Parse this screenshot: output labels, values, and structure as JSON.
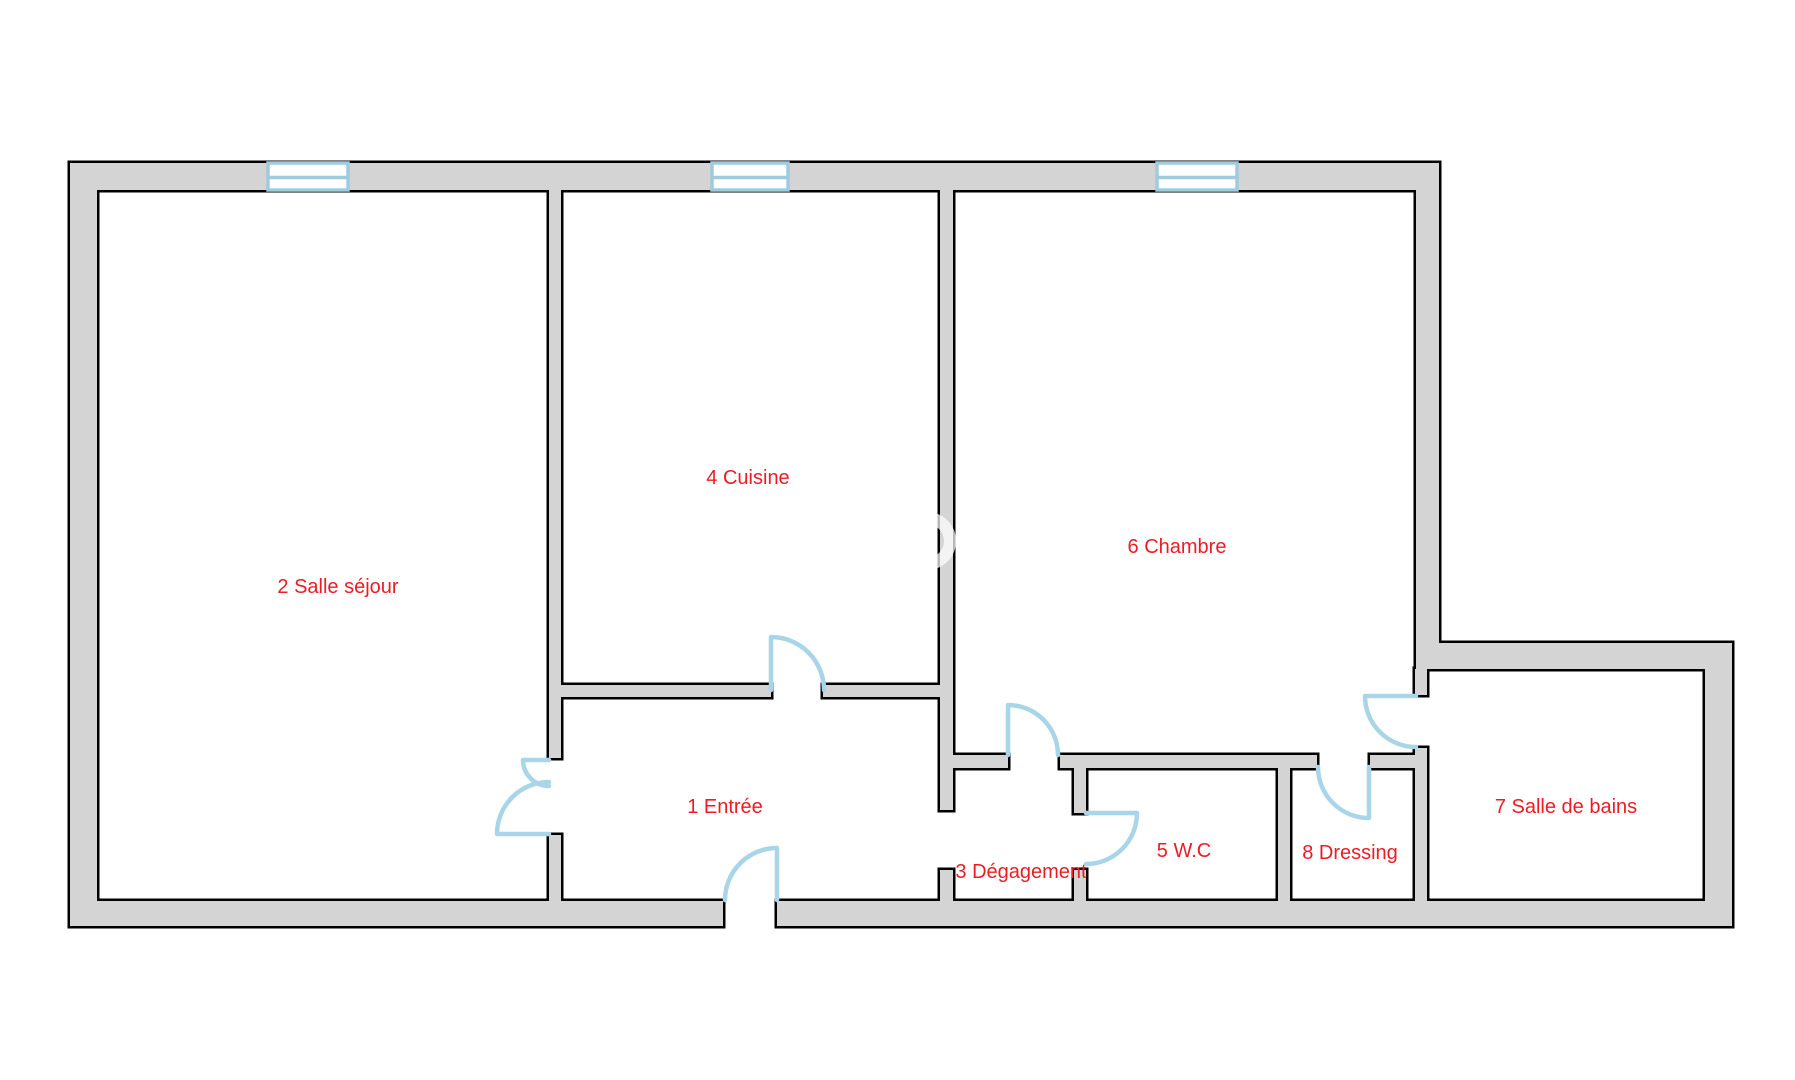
{
  "page": {
    "background": "#ffffff",
    "width": 1795,
    "height": 1080
  },
  "palette": {
    "wall_fill": "#d4d4d4",
    "wall_outline": "#000000",
    "window_color": "#9fcbdf",
    "door_color": "#a8d5e8",
    "label_color": "#ed1c24",
    "watermark_color": "rgba(255,255,255,0.72)"
  },
  "rooms": [
    {
      "number": "1",
      "name": "Entrée",
      "label": "1 Entrée",
      "cx": 725,
      "cy": 807
    },
    {
      "number": "2",
      "name": "Salle séjour",
      "label": "2 Salle séjour",
      "cx": 338,
      "cy": 587
    },
    {
      "number": "3",
      "name": "Dégagement",
      "label": "3 Dégagement",
      "cx": 1021,
      "cy": 872
    },
    {
      "number": "4",
      "name": "Cuisine",
      "label": "4 Cuisine",
      "cx": 748,
      "cy": 478
    },
    {
      "number": "5",
      "name": "W.C",
      "label": "5 W.C",
      "cx": 1184,
      "cy": 851
    },
    {
      "number": "6",
      "name": "Chambre",
      "label": "6 Chambre",
      "cx": 1177,
      "cy": 547
    },
    {
      "number": "7",
      "name": "Salle de bains",
      "label": "7 Salle de bains",
      "cx": 1566,
      "cy": 807
    },
    {
      "number": "8",
      "name": "Dressing",
      "label": "8 Dressing",
      "cx": 1350,
      "cy": 853
    }
  ],
  "floorplan": {
    "outline_pad": 2.5,
    "walls": [
      {
        "name": "exterior-top",
        "x": 70,
        "y": 163,
        "w": 1369,
        "h": 27
      },
      {
        "name": "exterior-left",
        "x": 70,
        "y": 163,
        "w": 27,
        "h": 763
      },
      {
        "name": "exterior-bottom-left",
        "x": 70,
        "y": 901,
        "w": 653,
        "h": 25
      },
      {
        "name": "exterior-bottom-right",
        "x": 777,
        "y": 901,
        "w": 953,
        "h": 25
      },
      {
        "name": "exterior-right-main",
        "x": 1416,
        "y": 163,
        "w": 23,
        "h": 506
      },
      {
        "name": "exterior-right-stub",
        "x": 1415,
        "y": 669,
        "w": 12,
        "h": 26
      },
      {
        "name": "extension-top",
        "x": 1416,
        "y": 643,
        "w": 314,
        "h": 26
      },
      {
        "name": "extension-right",
        "x": 1705,
        "y": 643,
        "w": 27,
        "h": 283
      },
      {
        "name": "sejour-cuisine-upper",
        "x": 549,
        "y": 190,
        "w": 12,
        "h": 568
      },
      {
        "name": "sejour-lower",
        "x": 549,
        "y": 835,
        "w": 12,
        "h": 66
      },
      {
        "name": "cuisine-bottom-left",
        "x": 549,
        "y": 685,
        "w": 222,
        "h": 12
      },
      {
        "name": "cuisine-bottom-right",
        "x": 823,
        "y": 685,
        "w": 129,
        "h": 12
      },
      {
        "name": "cuisine-chambre",
        "x": 940,
        "y": 190,
        "w": 13,
        "h": 620
      },
      {
        "name": "degagement-stub-horiz",
        "x": 952,
        "y": 755,
        "w": 56,
        "h": 13
      },
      {
        "name": "degagement-stub-lower",
        "x": 940,
        "y": 870,
        "w": 13,
        "h": 31
      },
      {
        "name": "chambre-bottom",
        "x": 1060,
        "y": 755,
        "w": 257,
        "h": 13
      },
      {
        "name": "dressing-top",
        "x": 1370,
        "y": 755,
        "w": 45,
        "h": 13
      },
      {
        "name": "wc-left-upper",
        "x": 1074,
        "y": 768,
        "w": 12,
        "h": 45
      },
      {
        "name": "wc-left-lower",
        "x": 1074,
        "y": 870,
        "w": 12,
        "h": 31
      },
      {
        "name": "wc-dressing-divider",
        "x": 1278,
        "y": 768,
        "w": 12,
        "h": 133
      },
      {
        "name": "bathroom-left",
        "x": 1415,
        "y": 748,
        "w": 12,
        "h": 153
      }
    ],
    "windows": [
      {
        "name": "window-sejour",
        "x": 268,
        "y": 163,
        "w": 80,
        "h": 27,
        "mid": 177.5
      },
      {
        "name": "window-cuisine",
        "x": 712,
        "y": 163,
        "w": 76,
        "h": 27,
        "mid": 177.5
      },
      {
        "name": "window-chambre",
        "x": 1157,
        "y": 163,
        "w": 80,
        "h": 27,
        "mid": 177.5
      }
    ],
    "doors": [
      {
        "name": "door-sejour-small-leaf",
        "path": "M549,760 L523,760 M523,760 A26,26 0 0 0 549,786"
      },
      {
        "name": "door-sejour-large-leaf",
        "path": "M549,834 L497,834 M497,834 A52,52 0 0 1 549,782"
      },
      {
        "name": "door-entrance",
        "path": "M777,900 L777,848 M725,900 A52,52 0 0 1 777,848"
      },
      {
        "name": "door-cuisine",
        "path": "M771,690 L771,637 M824,690 A53,53 0 0 0 771,637"
      },
      {
        "name": "door-chambre",
        "path": "M1008,755 L1008,705 M1008,705 A50,50 0 0 1 1058,755"
      },
      {
        "name": "door-wc",
        "path": "M1086,813 L1137,813 M1137,813 A51,51 0 0 1 1086,864"
      },
      {
        "name": "door-dressing",
        "path": "M1369,767 L1369,818 M1369,818 A51,51 0 0 1 1318,767"
      },
      {
        "name": "door-bathroom",
        "path": "M1416,696 L1365,696 M1365,696 A51,51 0 0 0 1416,747"
      }
    ],
    "watermark": {
      "cx": 927,
      "cy": 541,
      "r": 23,
      "stroke_width": 12
    }
  }
}
